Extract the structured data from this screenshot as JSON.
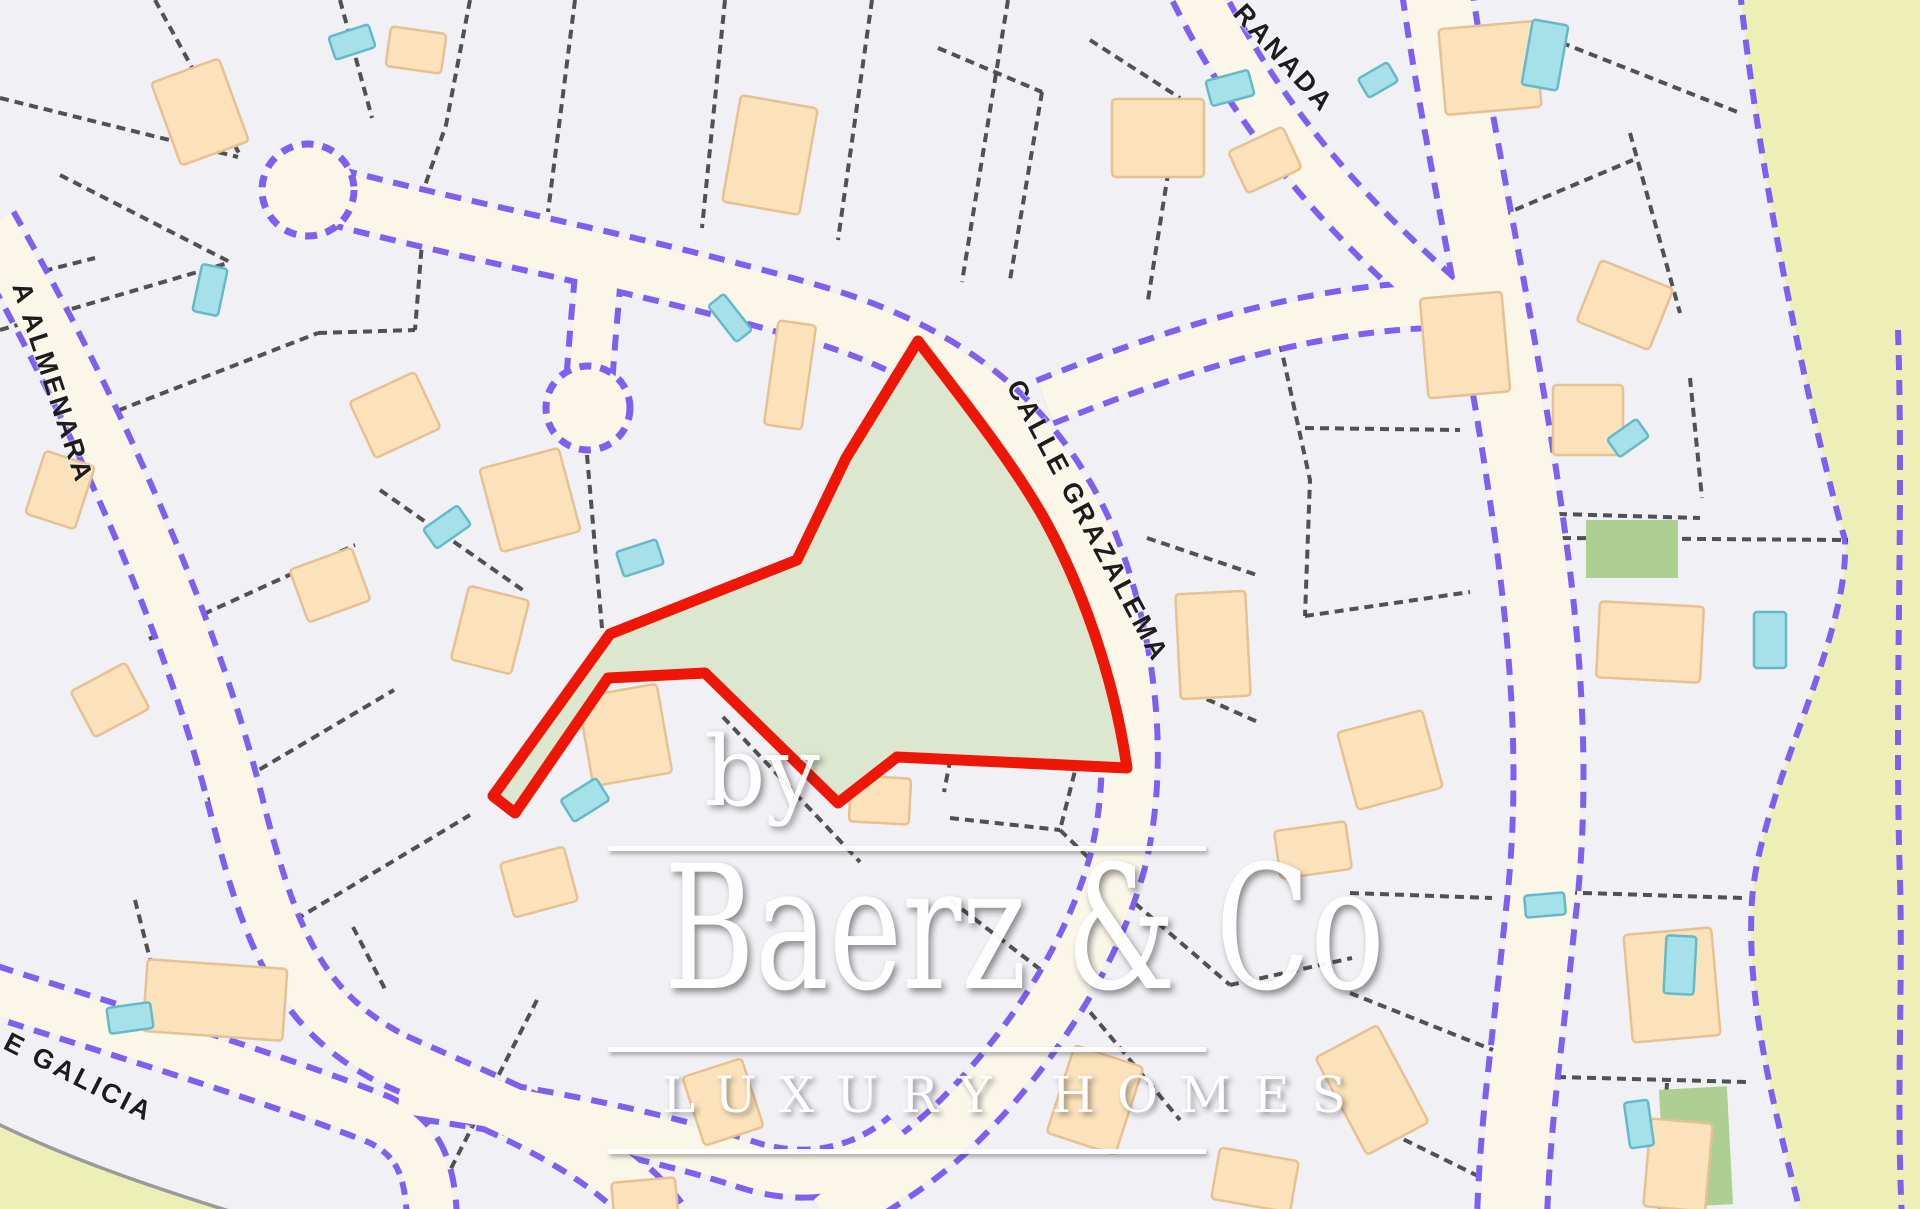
{
  "map": {
    "title": "Urbanisation plot map with highlighted parcel",
    "streets": [
      {
        "id": "grazalema",
        "label": "CALLE GRAZALEMA"
      },
      {
        "id": "granada",
        "label": "RANADA"
      },
      {
        "id": "almenara",
        "label": "A ALMENARA"
      },
      {
        "id": "galicia",
        "label": "E GALICIA"
      }
    ],
    "highlighted_plot": {
      "name": "plot-for-sale",
      "fill": "#dbe7ce",
      "outline": "#ee1607"
    }
  },
  "watermark": {
    "by": "by",
    "brand": "Baerz & Co",
    "tagline": "LUXURY HOMES"
  },
  "colors": {
    "parcel": "#f1f0f5",
    "road": "#faf7e8",
    "road-border": "#7e5ff0",
    "parcel-line": "#3a3a3a",
    "building": "#fbe2ba",
    "building-border": "#e5c193",
    "pool": "#a6e0e8",
    "pool-border": "#64bac8",
    "plot-fill": "#dbe7ce",
    "plot-outline": "#ee1607",
    "terrain": "#edf0b6",
    "green-parcel": "#aecf92",
    "label": "#1d1d1d",
    "watermark": "#ffffff"
  }
}
